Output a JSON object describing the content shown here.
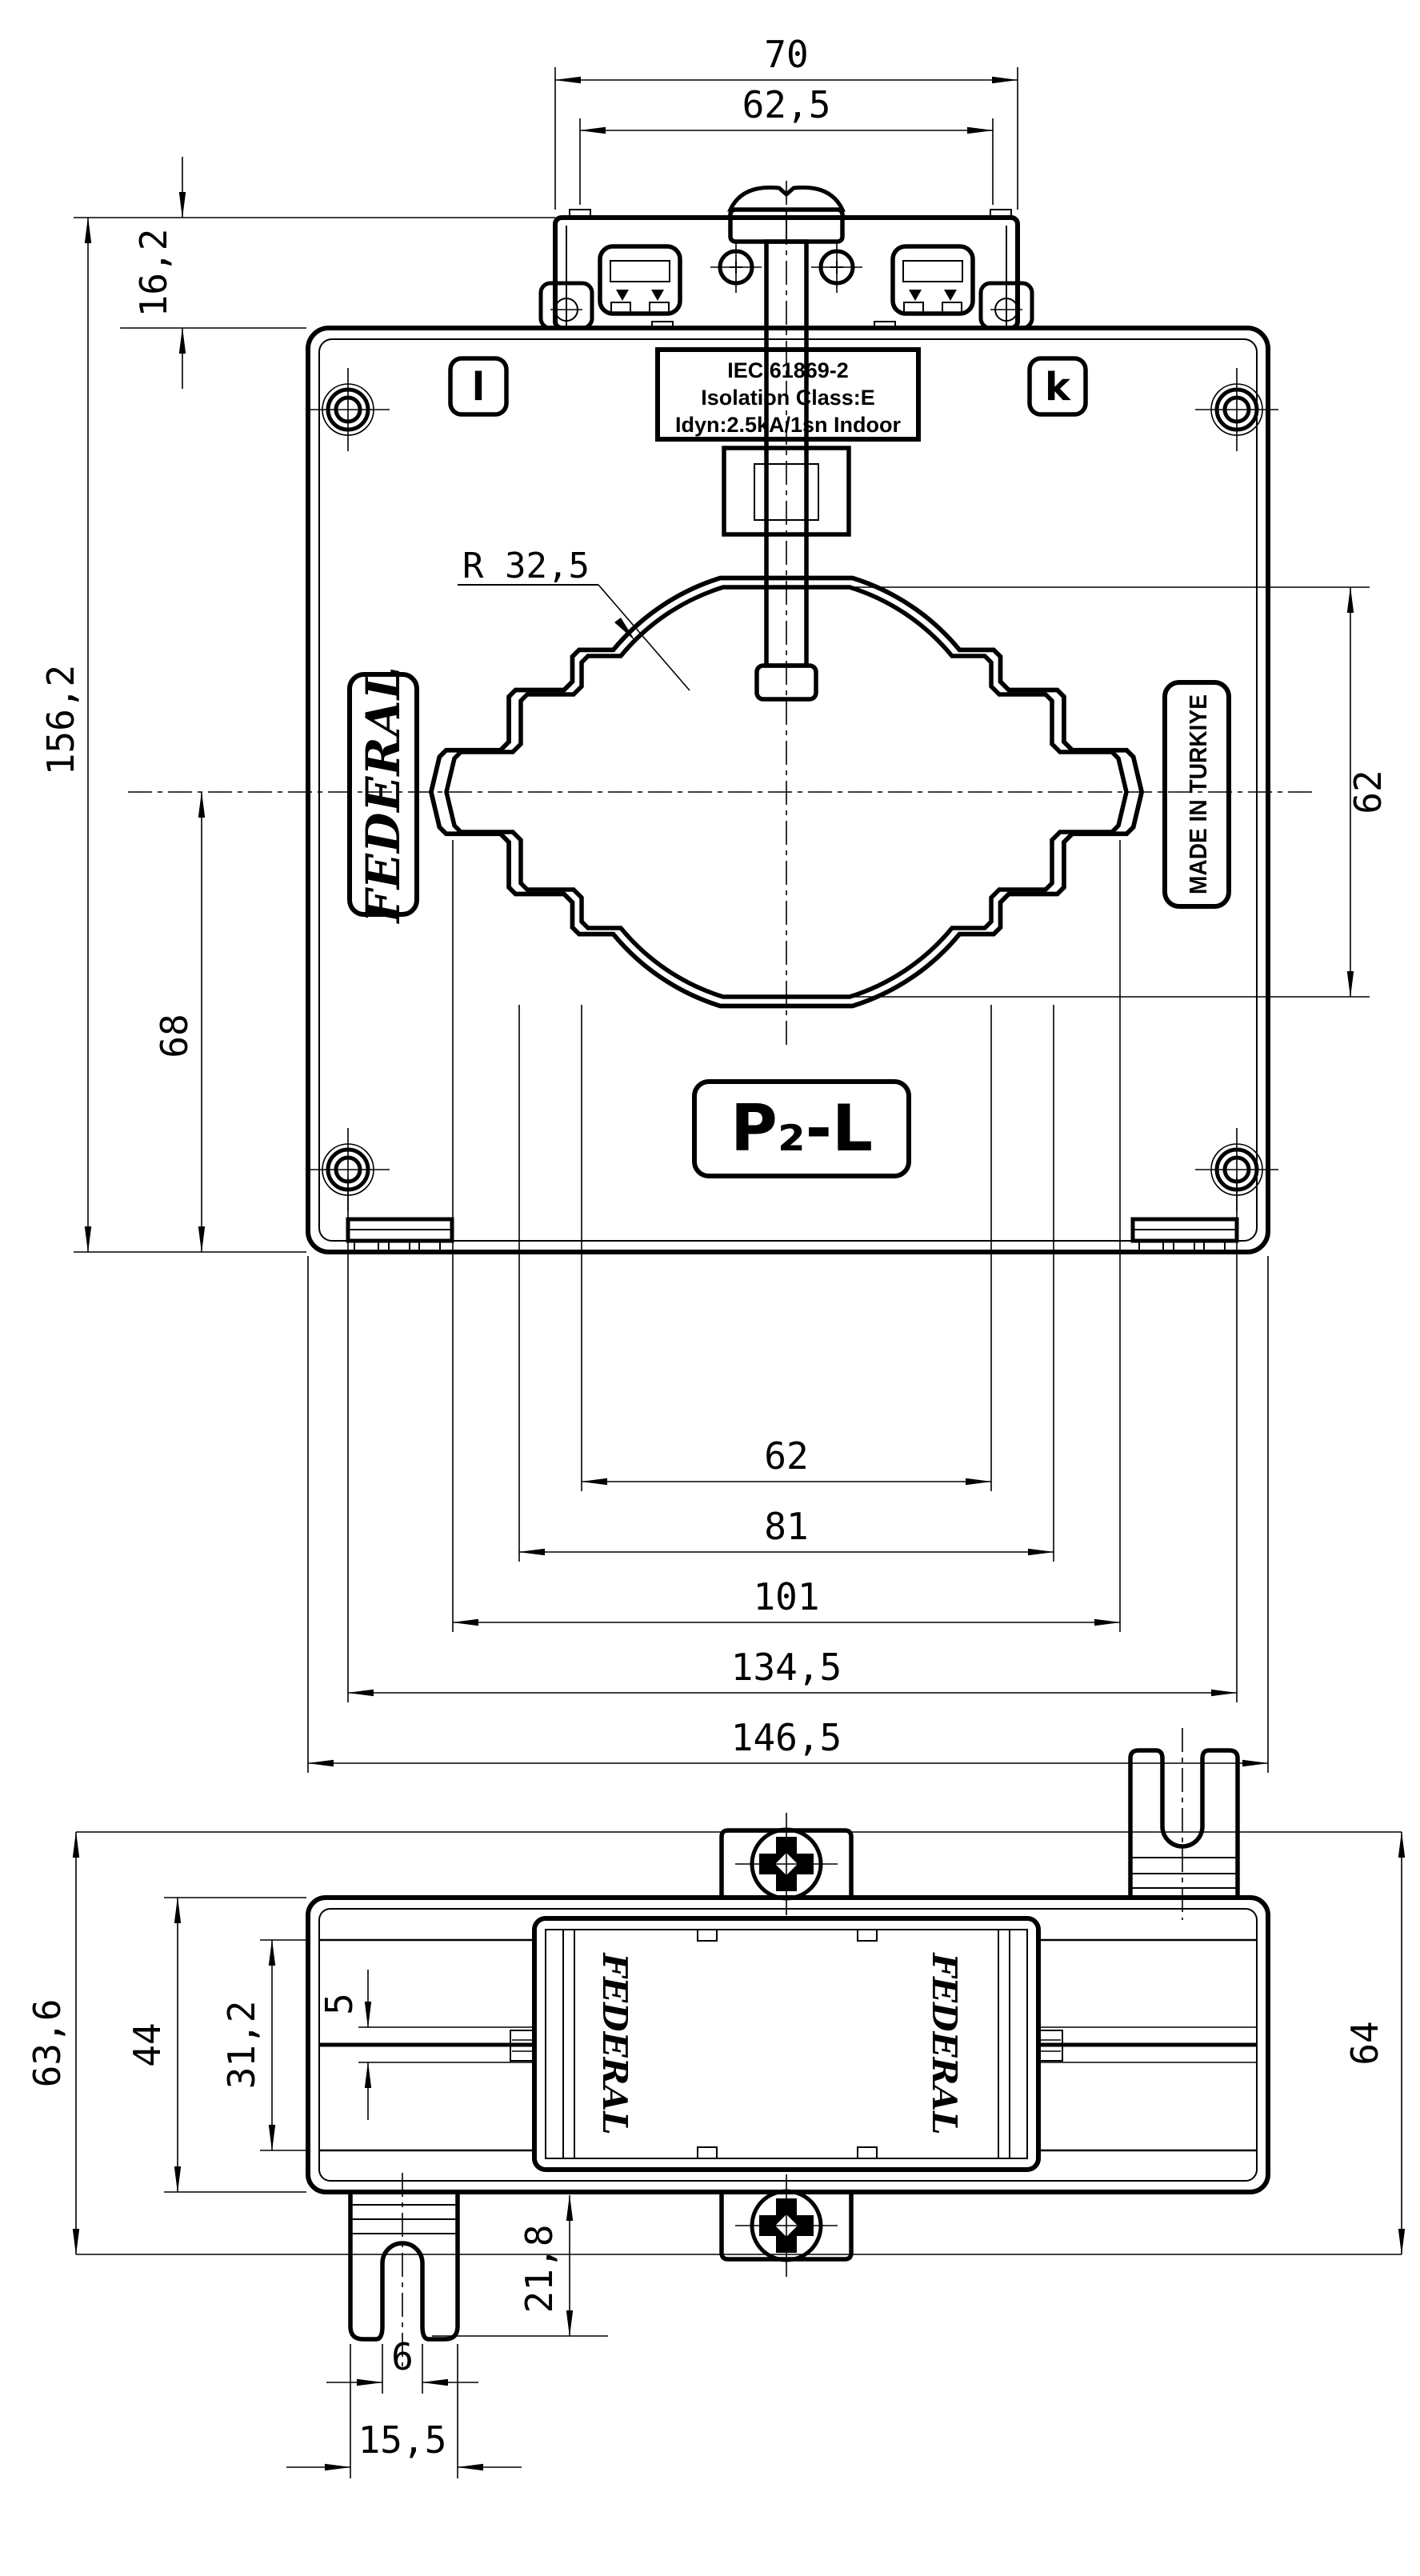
{
  "front": {
    "dims": {
      "top_width": "70",
      "terminal_span": "62,5",
      "terminal_height": "16,2",
      "overall_height": "156,2",
      "center_to_bottom": "68",
      "window_height": "62",
      "radius": "R 32,5",
      "window_width": "62",
      "step_width": "81",
      "outer_step_width": "101",
      "mount_span": "134,5",
      "overall_width": "146,5"
    },
    "labels": {
      "nameplate_line1": "IEC 61869-2",
      "nameplate_line2": "Isolation Class:E",
      "nameplate_line3": "Idyn:2.5kA/1sn Indoor",
      "terminal_left": "l",
      "terminal_right": "k",
      "brand": "FEDERAL",
      "origin": "MADE IN TURKIYE",
      "polarity": "P₂-L"
    }
  },
  "side": {
    "dims": {
      "overall_height": "63,6",
      "body_height": "44",
      "cover_height": "31,2",
      "plate_thickness": "5",
      "right_height": "64",
      "foot_depth": "21,8",
      "slot_width": "6",
      "foot_width": "15,5"
    },
    "labels": {
      "cover_brand_left": "FEDERAL",
      "cover_brand_right": "FEDERAL"
    }
  }
}
